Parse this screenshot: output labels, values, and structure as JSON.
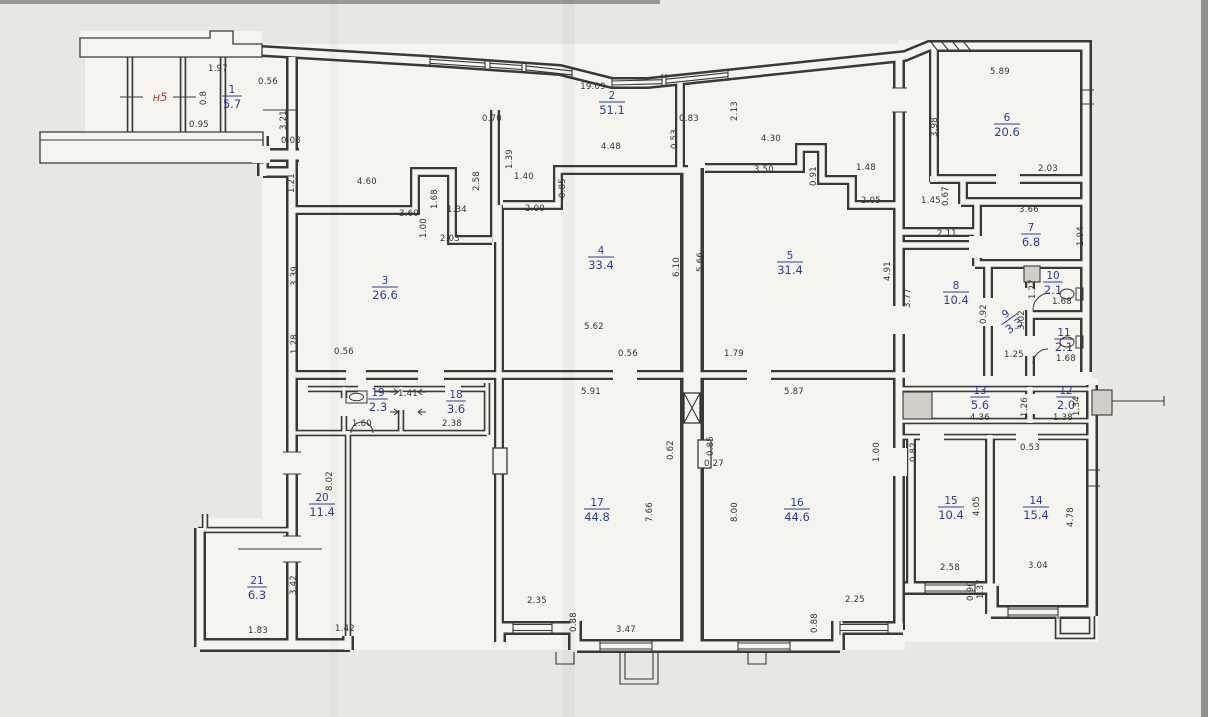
{
  "plan": {
    "entrance_label": {
      "text": "н5",
      "x": 160,
      "y": 101
    },
    "colors": {
      "line": "#3b3933",
      "blue": "#2c3ba4",
      "red": "#bf3a34",
      "paper": "#e9e7e1",
      "floor": "#f5f4ef"
    },
    "rooms": [
      {
        "n": "1",
        "area": "5.7",
        "x": 232,
        "y": 97
      },
      {
        "n": "2",
        "area": "51.1",
        "x": 612,
        "y": 103
      },
      {
        "n": "3",
        "area": "26.6",
        "x": 385,
        "y": 288
      },
      {
        "n": "4",
        "area": "33.4",
        "x": 601,
        "y": 258
      },
      {
        "n": "5",
        "area": "31.4",
        "x": 790,
        "y": 263
      },
      {
        "n": "6",
        "area": "20.6",
        "x": 1007,
        "y": 125
      },
      {
        "n": "7",
        "area": "6.8",
        "x": 1031,
        "y": 235
      },
      {
        "n": "8",
        "area": "10.4",
        "x": 956,
        "y": 293
      },
      {
        "n": "9",
        "area": "3.3",
        "x": 1010,
        "y": 320,
        "rot": -35
      },
      {
        "n": "10",
        "area": "2.1",
        "x": 1053,
        "y": 283
      },
      {
        "n": "11",
        "area": "2.1",
        "x": 1064,
        "y": 340
      },
      {
        "n": "12",
        "area": "2.0",
        "x": 1066,
        "y": 398
      },
      {
        "n": "13",
        "area": "5.6",
        "x": 980,
        "y": 398
      },
      {
        "n": "14",
        "area": "15.4",
        "x": 1036,
        "y": 508
      },
      {
        "n": "15",
        "area": "10.4",
        "x": 951,
        "y": 508
      },
      {
        "n": "16",
        "area": "44.6",
        "x": 797,
        "y": 510
      },
      {
        "n": "17",
        "area": "44.8",
        "x": 597,
        "y": 510
      },
      {
        "n": "18",
        "area": "3.6",
        "x": 456,
        "y": 402
      },
      {
        "n": "19",
        "area": "2.3",
        "x": 378,
        "y": 400
      },
      {
        "n": "20",
        "area": "11.4",
        "x": 322,
        "y": 505
      },
      {
        "n": "21",
        "area": "6.3",
        "x": 257,
        "y": 588
      }
    ],
    "dims": [
      {
        "t": "1.97",
        "x": 218,
        "y": 71
      },
      {
        "t": "0.56",
        "x": 268,
        "y": 84
      },
      {
        "t": "0.8",
        "x": 206,
        "y": 98,
        "r": 1
      },
      {
        "t": "0.95",
        "x": 199,
        "y": 127
      },
      {
        "t": "0.08",
        "x": 291,
        "y": 143
      },
      {
        "t": "3.21",
        "x": 286,
        "y": 120,
        "r": 1
      },
      {
        "t": "1.21",
        "x": 294,
        "y": 183,
        "r": 1
      },
      {
        "t": "19.09",
        "x": 593,
        "y": 89
      },
      {
        "t": "2.13",
        "x": 737,
        "y": 111,
        "r": 1
      },
      {
        "t": "0.70",
        "x": 492,
        "y": 121
      },
      {
        "t": "0.83",
        "x": 689,
        "y": 121
      },
      {
        "t": "0.53",
        "x": 677,
        "y": 139,
        "r": 1
      },
      {
        "t": "4.48",
        "x": 611,
        "y": 149
      },
      {
        "t": "4.30",
        "x": 771,
        "y": 141
      },
      {
        "t": "1.39",
        "x": 512,
        "y": 159,
        "r": 1
      },
      {
        "t": "2.58",
        "x": 479,
        "y": 181,
        "r": 1
      },
      {
        "t": "1.40",
        "x": 524,
        "y": 179
      },
      {
        "t": "0.85",
        "x": 565,
        "y": 188,
        "r": 1
      },
      {
        "t": "2.00",
        "x": 535,
        "y": 211
      },
      {
        "t": "3.50",
        "x": 764,
        "y": 172
      },
      {
        "t": "0.91",
        "x": 816,
        "y": 176,
        "r": 1
      },
      {
        "t": "1.48",
        "x": 866,
        "y": 170
      },
      {
        "t": "2.05",
        "x": 871,
        "y": 203
      },
      {
        "t": "4.60",
        "x": 367,
        "y": 184
      },
      {
        "t": "1.68",
        "x": 437,
        "y": 199,
        "r": 1
      },
      {
        "t": "3.60",
        "x": 409,
        "y": 216
      },
      {
        "t": "1.00",
        "x": 426,
        "y": 228,
        "r": 1
      },
      {
        "t": "1.34",
        "x": 457,
        "y": 212
      },
      {
        "t": "2.03",
        "x": 450,
        "y": 241
      },
      {
        "t": "3.39",
        "x": 297,
        "y": 276,
        "r": 1
      },
      {
        "t": "1.28",
        "x": 297,
        "y": 344,
        "r": 1
      },
      {
        "t": "0.56",
        "x": 344,
        "y": 354
      },
      {
        "t": "6.10",
        "x": 679,
        "y": 267,
        "r": 1
      },
      {
        "t": "5.66",
        "x": 703,
        "y": 262,
        "r": 1
      },
      {
        "t": "5.62",
        "x": 594,
        "y": 329
      },
      {
        "t": "0.56",
        "x": 628,
        "y": 356
      },
      {
        "t": "1.79",
        "x": 734,
        "y": 356
      },
      {
        "t": "4.91",
        "x": 890,
        "y": 271,
        "r": 1
      },
      {
        "t": "5.89",
        "x": 1000,
        "y": 74
      },
      {
        "t": "3.98",
        "x": 937,
        "y": 127,
        "r": 1
      },
      {
        "t": "2.03",
        "x": 1048,
        "y": 171
      },
      {
        "t": "1.45",
        "x": 931,
        "y": 203
      },
      {
        "t": "0.67",
        "x": 948,
        "y": 196,
        "r": 1
      },
      {
        "t": "2.11",
        "x": 947,
        "y": 236
      },
      {
        "t": "3.66",
        "x": 1029,
        "y": 212
      },
      {
        "t": "1.94",
        "x": 1083,
        "y": 236,
        "r": 1
      },
      {
        "t": "3.77",
        "x": 910,
        "y": 298,
        "r": 1
      },
      {
        "t": "1.27",
        "x": 1035,
        "y": 289,
        "r": 1
      },
      {
        "t": "1.68",
        "x": 1062,
        "y": 304
      },
      {
        "t": "0.92",
        "x": 986,
        "y": 314,
        "r": 1
      },
      {
        "t": "3.02",
        "x": 1024,
        "y": 320,
        "r": 1
      },
      {
        "t": "1.25",
        "x": 1014,
        "y": 357
      },
      {
        "t": "1.68",
        "x": 1066,
        "y": 361
      },
      {
        "t": "4.36",
        "x": 980,
        "y": 420
      },
      {
        "t": "1.26",
        "x": 1027,
        "y": 407,
        "r": 1
      },
      {
        "t": "1.38",
        "x": 1063,
        "y": 420
      },
      {
        "t": "1.34",
        "x": 1079,
        "y": 406,
        "r": 1
      },
      {
        "t": "0.82",
        "x": 916,
        "y": 452,
        "r": 1
      },
      {
        "t": "0.53",
        "x": 1030,
        "y": 450
      },
      {
        "t": "1.00",
        "x": 879,
        "y": 452,
        "r": 1
      },
      {
        "t": "4.05",
        "x": 979,
        "y": 506,
        "r": 1
      },
      {
        "t": "4.78",
        "x": 1073,
        "y": 517,
        "r": 1
      },
      {
        "t": "2.58",
        "x": 950,
        "y": 570
      },
      {
        "t": "3.04",
        "x": 1038,
        "y": 568
      },
      {
        "t": "1.37",
        "x": 983,
        "y": 589,
        "r": 1
      },
      {
        "t": "0.90",
        "x": 973,
        "y": 591,
        "r": 1
      },
      {
        "t": "5.91",
        "x": 591,
        "y": 394
      },
      {
        "t": "5.87",
        "x": 794,
        "y": 394
      },
      {
        "t": "0.62",
        "x": 673,
        "y": 450,
        "r": 1
      },
      {
        "t": "0.85",
        "x": 713,
        "y": 446,
        "r": 1
      },
      {
        "t": "0.27",
        "x": 714,
        "y": 466
      },
      {
        "t": "7.66",
        "x": 652,
        "y": 512,
        "r": 1
      },
      {
        "t": "8.00",
        "x": 737,
        "y": 512,
        "r": 1
      },
      {
        "t": "2.35",
        "x": 537,
        "y": 603
      },
      {
        "t": "0.88",
        "x": 576,
        "y": 622,
        "r": 1
      },
      {
        "t": "3.47",
        "x": 626,
        "y": 632
      },
      {
        "t": "0.88",
        "x": 817,
        "y": 623,
        "r": 1
      },
      {
        "t": "2.25",
        "x": 855,
        "y": 602
      },
      {
        "t": "1.60",
        "x": 362,
        "y": 426
      },
      {
        "t": "2.38",
        "x": 452,
        "y": 426
      },
      {
        "t": "1.41",
        "x": 408,
        "y": 396
      },
      {
        "t": "8.02",
        "x": 332,
        "y": 481,
        "r": 1
      },
      {
        "t": "3.42",
        "x": 296,
        "y": 585,
        "r": 1
      },
      {
        "t": "1.83",
        "x": 258,
        "y": 633
      },
      {
        "t": "1.42",
        "x": 345,
        "y": 631
      }
    ]
  }
}
